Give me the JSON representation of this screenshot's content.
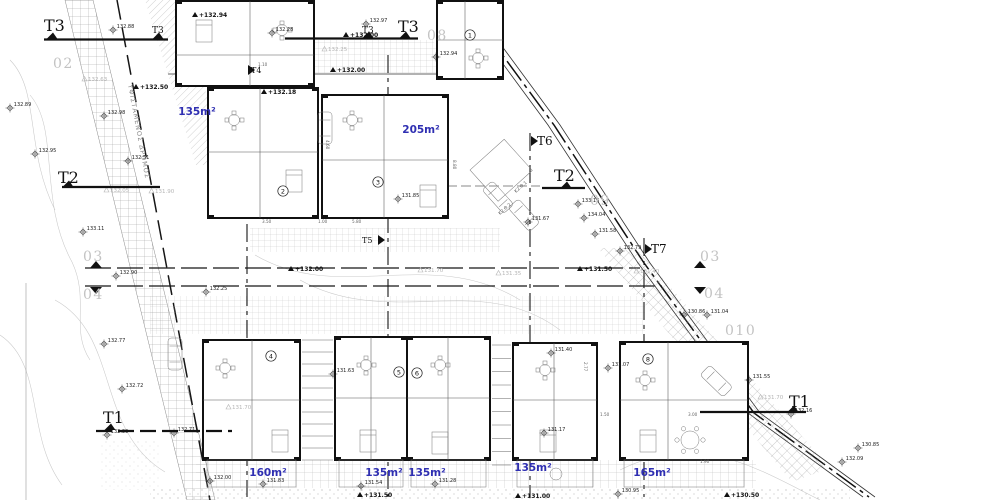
{
  "drawing": {
    "type": "architectural-site-plan",
    "road_label": "ΥΦΙΣΤΑΜΕΝΟΣ ΔΡΟΜΟΣ",
    "colors": {
      "area_label": "#2f2fb2",
      "gray_label": "#c3c3c3",
      "line": "#111111",
      "level_gray": "#b5b5b5"
    },
    "section_markers": [
      {
        "label": "T3",
        "x": 44,
        "y": 31,
        "size": 16,
        "tri": [
          52,
          39
        ],
        "tdir": "up",
        "line": [
          44,
          39.5,
          168,
          39.5
        ]
      },
      {
        "label": "T3",
        "x": 152,
        "y": 33,
        "size": 9,
        "tri": [
          158,
          39
        ],
        "tdir": "up"
      },
      {
        "label": "T3",
        "x": 362,
        "y": 33,
        "size": 9,
        "tri": [
          368,
          38
        ],
        "tdir": "up"
      },
      {
        "label": "T3",
        "x": 398,
        "y": 32,
        "size": 16,
        "tri": [
          405,
          38
        ],
        "tdir": "up",
        "line": [
          285,
          38.5,
          418,
          38.5
        ]
      },
      {
        "label": "T2",
        "x": 58,
        "y": 183,
        "size": 16,
        "tri": [
          68,
          187
        ],
        "tdir": "up",
        "line": [
          62,
          187,
          160,
          187
        ]
      },
      {
        "label": "T2",
        "x": 554,
        "y": 181,
        "size": 16,
        "tri": [
          566,
          188
        ],
        "tdir": "up",
        "line": [
          542,
          188,
          585,
          188
        ]
      },
      {
        "label": "T6",
        "x": 537,
        "y": 145,
        "size": 12,
        "tri": [
          531,
          141
        ],
        "tdir": "right"
      },
      {
        "label": "T7",
        "x": 651,
        "y": 253,
        "size": 12,
        "tri": [
          645,
          249
        ],
        "tdir": "right"
      },
      {
        "label": "T4",
        "x": 251,
        "y": 73,
        "size": 8,
        "tri": [
          248,
          70
        ],
        "tdir": "right"
      },
      {
        "label": "T5",
        "x": 362,
        "y": 243,
        "size": 8,
        "tri": [
          378,
          240
        ],
        "tdir": "right"
      },
      {
        "label": "T1",
        "x": 103,
        "y": 423,
        "size": 16,
        "tri": [
          110,
          430
        ],
        "tdir": "up",
        "line": [
          96,
          431,
          232,
          431
        ],
        "dash": true
      },
      {
        "label": "T1",
        "x": 789,
        "y": 407,
        "size": 16,
        "tri": [
          793,
          412
        ],
        "tdir": "up",
        "line": [
          700,
          412,
          806,
          412
        ]
      }
    ],
    "point_labels": [
      {
        "label": "02",
        "x": 53,
        "y": 68
      },
      {
        "label": "08",
        "x": 427,
        "y": 40
      },
      {
        "label": "09",
        "x": 590,
        "y": 205
      },
      {
        "label": "03",
        "x": 83,
        "y": 261
      },
      {
        "label": "04",
        "x": 83,
        "y": 299
      },
      {
        "label": "03",
        "x": 700,
        "y": 261
      },
      {
        "label": "04",
        "x": 704,
        "y": 298
      },
      {
        "label": "010",
        "x": 725,
        "y": 335
      }
    ],
    "area_labels": [
      {
        "label": "135m²",
        "x": 197,
        "y": 115
      },
      {
        "label": "205m²",
        "x": 421,
        "y": 133
      },
      {
        "label": "160m²",
        "x": 268,
        "y": 476
      },
      {
        "label": "135m²",
        "x": 384,
        "y": 476
      },
      {
        "label": "135m²",
        "x": 427,
        "y": 476
      },
      {
        "label": "135m²",
        "x": 533,
        "y": 471
      },
      {
        "label": "165m²",
        "x": 652,
        "y": 476
      }
    ],
    "unit_numbers": [
      {
        "label": "1",
        "x": 470,
        "y": 35
      },
      {
        "label": "2",
        "x": 283,
        "y": 191
      },
      {
        "label": "3",
        "x": 378,
        "y": 182
      },
      {
        "label": "4",
        "x": 271,
        "y": 356
      },
      {
        "label": "5",
        "x": 399,
        "y": 372
      },
      {
        "label": "6",
        "x": 417,
        "y": 373
      },
      {
        "label": "8",
        "x": 648,
        "y": 359
      }
    ],
    "spot_elevations": [
      {
        "v": "132.88",
        "x": 113,
        "y": 30
      },
      {
        "v": "132.97",
        "x": 366,
        "y": 24
      },
      {
        "v": "132.94",
        "x": 436,
        "y": 57
      },
      {
        "v": "132.28",
        "x": 272,
        "y": 33
      },
      {
        "v": "132.89",
        "x": 10,
        "y": 108
      },
      {
        "v": "132.98",
        "x": 104,
        "y": 116
      },
      {
        "v": "132.95",
        "x": 35,
        "y": 154
      },
      {
        "v": "132.51",
        "x": 128,
        "y": 161
      },
      {
        "v": "133.11",
        "x": 83,
        "y": 232
      },
      {
        "v": "132.90",
        "x": 116,
        "y": 276
      },
      {
        "v": "132.25",
        "x": 206,
        "y": 292
      },
      {
        "v": "131.85",
        "x": 398,
        "y": 199
      },
      {
        "v": "131.67",
        "x": 528,
        "y": 222
      },
      {
        "v": "133.16",
        "x": 578,
        "y": 204
      },
      {
        "v": "134.04",
        "x": 584,
        "y": 218
      },
      {
        "v": "131.58",
        "x": 595,
        "y": 234
      },
      {
        "v": "132.79",
        "x": 620,
        "y": 251
      },
      {
        "v": "130.86",
        "x": 684,
        "y": 315
      },
      {
        "v": "131.04",
        "x": 707,
        "y": 315
      },
      {
        "v": "132.77",
        "x": 104,
        "y": 344
      },
      {
        "v": "132.72",
        "x": 122,
        "y": 389
      },
      {
        "v": "132.39",
        "x": 107,
        "y": 435
      },
      {
        "v": "132.71",
        "x": 174,
        "y": 433
      },
      {
        "v": "132.00",
        "x": 210,
        "y": 481
      },
      {
        "v": "131.63",
        "x": 333,
        "y": 374
      },
      {
        "v": "131.83",
        "x": 263,
        "y": 484
      },
      {
        "v": "131.54",
        "x": 361,
        "y": 486
      },
      {
        "v": "131.28",
        "x": 435,
        "y": 484
      },
      {
        "v": "131.40",
        "x": 551,
        "y": 353
      },
      {
        "v": "131.07",
        "x": 608,
        "y": 368
      },
      {
        "v": "131.17",
        "x": 544,
        "y": 433
      },
      {
        "v": "131.55",
        "x": 749,
        "y": 380
      },
      {
        "v": "132.16",
        "x": 791,
        "y": 414
      },
      {
        "v": "130.85",
        "x": 858,
        "y": 448
      },
      {
        "v": "132.09",
        "x": 842,
        "y": 462
      },
      {
        "v": "130.95",
        "x": 618,
        "y": 494
      }
    ],
    "level_labels": [
      {
        "v": "+132.50",
        "x": 140,
        "y": 89
      },
      {
        "v": "+132.00",
        "x": 350,
        "y": 37
      },
      {
        "v": "+132.00",
        "x": 337,
        "y": 72
      },
      {
        "v": "+132.00",
        "x": 295,
        "y": 271
      },
      {
        "v": "+131.50",
        "x": 584,
        "y": 271
      },
      {
        "v": "+131.50",
        "x": 364,
        "y": 497
      },
      {
        "v": "+131.00",
        "x": 522,
        "y": 498
      },
      {
        "v": "+130.50",
        "x": 731,
        "y": 497
      },
      {
        "v": "+132.18",
        "x": 268,
        "y": 94
      },
      {
        "v": "+132.94",
        "x": 199,
        "y": 17
      }
    ],
    "gray_level_labels": [
      {
        "v": "132.63",
        "x": 88,
        "y": 81
      },
      {
        "v": "132.05",
        "x": 110,
        "y": 192
      },
      {
        "v": "131.90",
        "x": 155,
        "y": 193
      },
      {
        "v": "132.25",
        "x": 328,
        "y": 51
      },
      {
        "v": "131.70",
        "x": 424,
        "y": 272
      },
      {
        "v": "131.40",
        "x": 640,
        "y": 273
      },
      {
        "v": "131.70",
        "x": 764,
        "y": 399
      },
      {
        "v": "131.70",
        "x": 232,
        "y": 409
      },
      {
        "v": "131.35",
        "x": 502,
        "y": 275
      }
    ],
    "parking_labels": [
      {
        "label": "Κ2.Θ.1",
        "x": 516,
        "y": 193,
        "r": -42
      },
      {
        "label": "Κ2.Θ.2",
        "x": 500,
        "y": 215,
        "r": -42
      }
    ],
    "dim_labels": [
      {
        "t": "5.80",
        "x": 352,
        "y": 223,
        "r": 0
      },
      {
        "t": "3.50",
        "x": 262,
        "y": 223,
        "r": 0
      },
      {
        "t": "1.00",
        "x": 318,
        "y": 223,
        "r": 0
      },
      {
        "t": "8.80",
        "x": 453,
        "y": 160,
        "r": 90
      },
      {
        "t": "2.77",
        "x": 584,
        "y": 362,
        "r": 90
      },
      {
        "t": "3.00",
        "x": 688,
        "y": 416,
        "r": 0
      },
      {
        "t": "1.90",
        "x": 700,
        "y": 463,
        "r": 0
      },
      {
        "t": "1.10",
        "x": 258,
        "y": 66,
        "r": 0
      },
      {
        "t": "4.60",
        "x": 326,
        "y": 140,
        "r": 90
      },
      {
        "t": "1.50",
        "x": 600,
        "y": 416,
        "r": 0
      }
    ]
  }
}
